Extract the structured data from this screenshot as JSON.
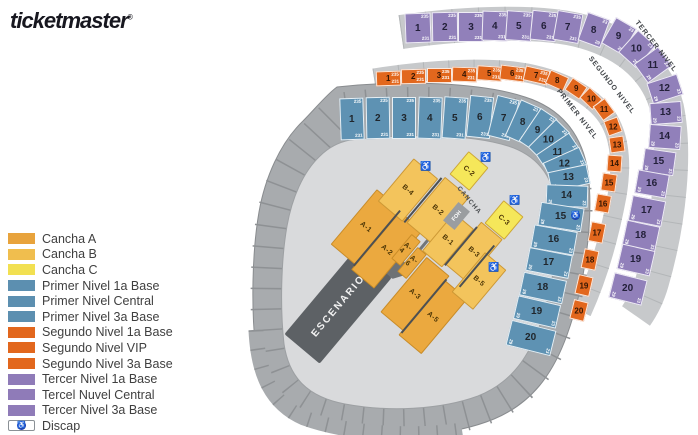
{
  "logo": {
    "text": "ticketmaster",
    "reg": "®"
  },
  "colors": {
    "cancha_a": "#EBA93F",
    "cancha_b": "#F3C45C",
    "cancha_c": "#F5E75A",
    "primer": "#5E92B3",
    "segundo": "#E2671D",
    "tercer": "#9180BA",
    "discap_blue": "#1F3BB3",
    "stage_gray": "#5D6165"
  },
  "legend": {
    "items": [
      {
        "label": "Cancha A",
        "color": "#E8A33C"
      },
      {
        "label": "Cancha B",
        "color": "#F0BE4E"
      },
      {
        "label": "Cancha C",
        "color": "#F2E051"
      },
      {
        "label": "Primer Nivel 1a Base",
        "color": "#5C8FB0"
      },
      {
        "label": "Primer Nivel Central",
        "color": "#5C8FB0"
      },
      {
        "label": "Primer Nivel 3a Base",
        "color": "#5C8FB0"
      },
      {
        "label": "Segundo Nivel 1a Base",
        "color": "#E2671D"
      },
      {
        "label": "Segundo Nivel VIP",
        "color": "#E2671D"
      },
      {
        "label": "Segundo Nivel 3a Base",
        "color": "#E2671D"
      },
      {
        "label": "Tercer Nivel 1a Base",
        "color": "#8F7BB8"
      },
      {
        "label": "Tercel Nuvel Central",
        "color": "#8F7BB8"
      },
      {
        "label": "Tercer Nivel 3a Base",
        "color": "#8F7BB8"
      },
      {
        "label": "Discap",
        "icon": "discap"
      }
    ]
  },
  "map": {
    "stage_label": "ESCENARIO",
    "foh_label": "FOH",
    "cancha_walkway_label": "CANCHA",
    "wheelchair_symbol": "♿",
    "row_hints": {
      "top_row": [
        "235",
        "231"
      ],
      "column": [
        "23",
        "29"
      ]
    },
    "primer": {
      "label": "PRIMER NIVEL",
      "sections": [
        "1",
        "2",
        "3",
        "4",
        "5",
        "6",
        "7",
        "8",
        "9",
        "10",
        "11",
        "12",
        "13",
        "14",
        "15",
        "16",
        "17",
        "18",
        "19",
        "20"
      ]
    },
    "segundo": {
      "label": "SEGUNDO NIVEL",
      "sections": [
        "1",
        "2",
        "3",
        "4",
        "5",
        "6",
        "7",
        "8",
        "9",
        "10",
        "11",
        "12",
        "13",
        "14",
        "15",
        "16",
        "17",
        "18",
        "19",
        "20"
      ]
    },
    "tercer": {
      "label": "TERCER NIVEL",
      "sections": [
        "1",
        "2",
        "3",
        "4",
        "5",
        "6",
        "7",
        "8",
        "9",
        "10",
        "11",
        "12",
        "13",
        "14",
        "15",
        "16",
        "17",
        "18",
        "19",
        "20"
      ]
    },
    "cancha": {
      "sections": [
        {
          "label": "A-1",
          "type": "cancha_a"
        },
        {
          "label": "A-2",
          "type": "cancha_a"
        },
        {
          "label": "A-3",
          "type": "cancha_a"
        },
        {
          "label": "A-5",
          "type": "cancha_a"
        },
        {
          "label": "A-4",
          "type": "cancha_a"
        },
        {
          "label": "A-6",
          "type": "cancha_a"
        },
        {
          "label": "B-4",
          "type": "cancha_b"
        },
        {
          "label": "B-2",
          "type": "cancha_b"
        },
        {
          "label": "B-1",
          "type": "cancha_b"
        },
        {
          "label": "B-3",
          "type": "cancha_b"
        },
        {
          "label": "B-5",
          "type": "cancha_b"
        },
        {
          "label": "C-2",
          "type": "cancha_c"
        },
        {
          "label": "C-3",
          "type": "cancha_c"
        }
      ]
    }
  }
}
